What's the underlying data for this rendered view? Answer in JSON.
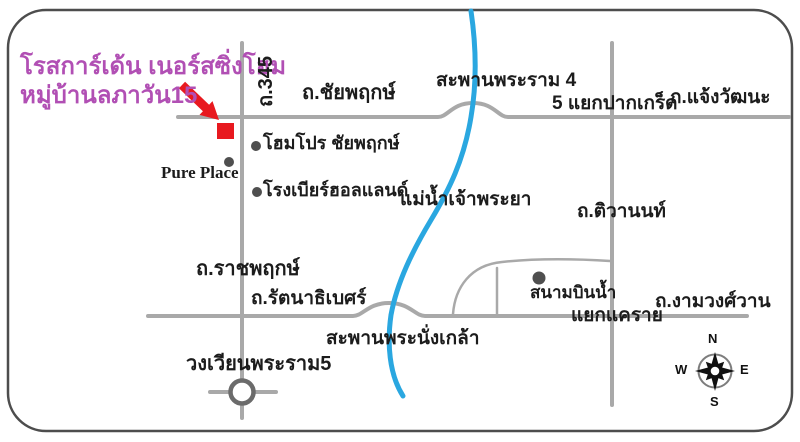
{
  "destination": {
    "name_line1": "โรสการ์เด้น เนอร์สซิ่งโฮม",
    "name_line2": "หมู่บ้านลภาวัน15"
  },
  "roads": {
    "route345": "ถ.345",
    "chaiyaphruek": "ถ.ชัยพฤกษ์",
    "chaengwattana": "ถ.แจ้งวัฒนะ",
    "tiwanon": "ถ.ติวานนท์",
    "ratchaphruek": "ถ.ราชพฤกษ์",
    "rattanathibet": "ถ.รัตนาธิเบศร์",
    "ngamwongwan": "ถ.งามวงศ์วาน"
  },
  "junctions": {
    "pakkret": "5 แยกปากเกร็ด",
    "khaerai": "แยกแคราย",
    "rama5_roundabout": "วงเวียนพระราม5"
  },
  "bridges": {
    "rama4": "สะพานพระราม 4",
    "nangklao": "สะพานพระนั่งเกล้า"
  },
  "river": {
    "chaophraya": "แม่น้ำเจ้าพระยา"
  },
  "landmarks": {
    "homepro": "โฮมโปร ชัยพฤกษ์",
    "pure_place": "Pure Place",
    "beer_holland": "โรงเบียร์ฮอลแลนด์",
    "sanambinnam": "สนามบินน้ำ"
  },
  "compass": {
    "n": "N",
    "e": "E",
    "s": "S",
    "w": "W"
  },
  "colors": {
    "highlight_text": "#b14fb4",
    "marker_red": "#e8191f",
    "river_blue": "#2aa7e0",
    "road_gray": "#a9a9a9"
  }
}
